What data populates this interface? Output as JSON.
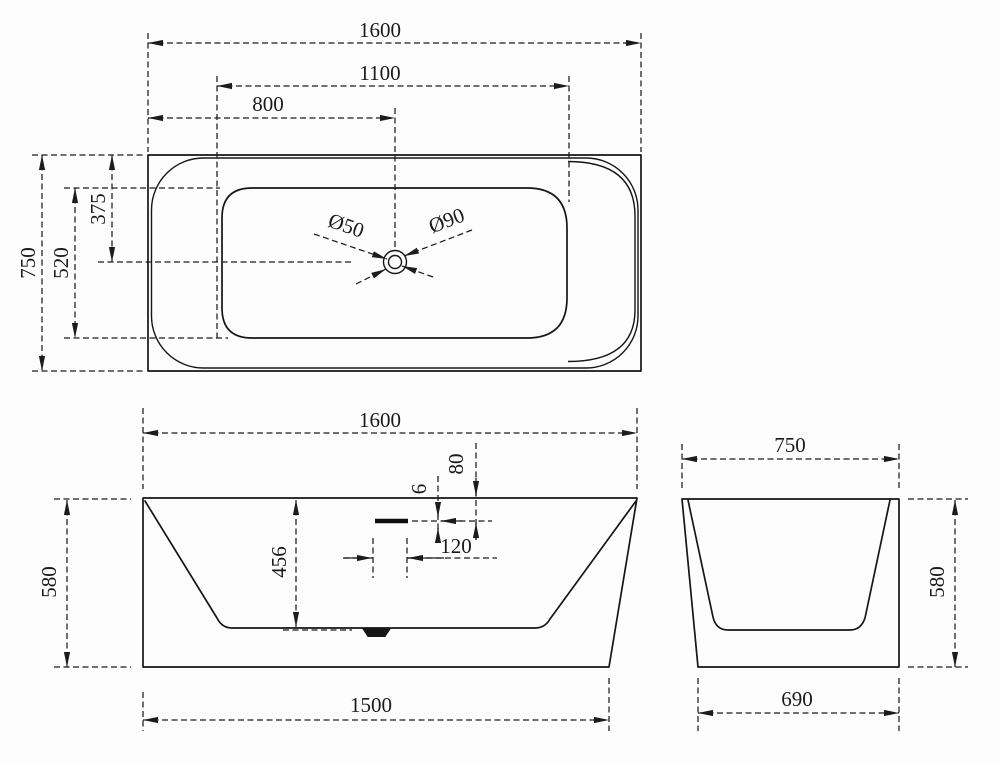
{
  "drawing": {
    "top_view": {
      "length": "1600",
      "inner_length": "1100",
      "drain_from_left": "800",
      "width": "750",
      "inner_width": "520",
      "drain_from_back": "375",
      "drain_diameter": "Ø50",
      "drain_flange_diameter": "Ø90"
    },
    "front_view": {
      "length": "1600",
      "height": "580",
      "inner_depth": "456",
      "overflow_from_rim": "80",
      "overflow_slot_height": "6",
      "overflow_slot_length": "120",
      "base_length": "1500"
    },
    "side_view": {
      "width": "750",
      "height": "580",
      "base_width": "690"
    }
  }
}
